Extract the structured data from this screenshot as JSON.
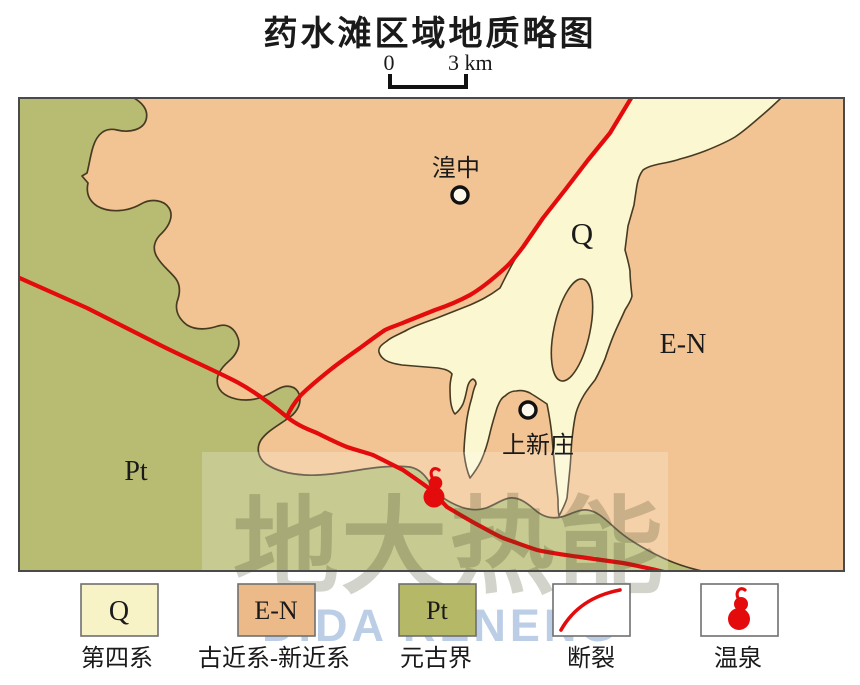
{
  "title": "药水滩区域地质略图",
  "scale_bar": {
    "zero_label": "0",
    "distance_label": "3 km"
  },
  "map": {
    "unit_labels": {
      "quaternary": "Q",
      "paleogene_neogene": "E-N",
      "proterozoic": "Pt"
    },
    "towns": [
      {
        "name": "湟中"
      },
      {
        "name": "上新庄"
      }
    ]
  },
  "legend": {
    "items": [
      {
        "symbol": "Q",
        "label": "第四系",
        "color": "#F7F3C6"
      },
      {
        "symbol": "E-N",
        "label": "古近系-新近系",
        "color": "#EBBA88"
      },
      {
        "symbol": "Pt",
        "label": "元古界",
        "color": "#B5B967"
      },
      {
        "symbol": "",
        "label": "断裂",
        "color": "#FFFFFF"
      },
      {
        "symbol": "",
        "label": "温泉",
        "color": "#FFFFFF"
      }
    ]
  },
  "watermark": {
    "text": "地大热能",
    "subtext": "DIDA RENENG"
  },
  "colors": {
    "quaternary": "#FBF7D0",
    "paleogene_neogene": "#F2C493",
    "proterozoic": "#B8BC72",
    "boundary": "#473A22",
    "fault": "#E30B0B",
    "spring": "#E30B0B",
    "frame": "#4A4A4A"
  }
}
